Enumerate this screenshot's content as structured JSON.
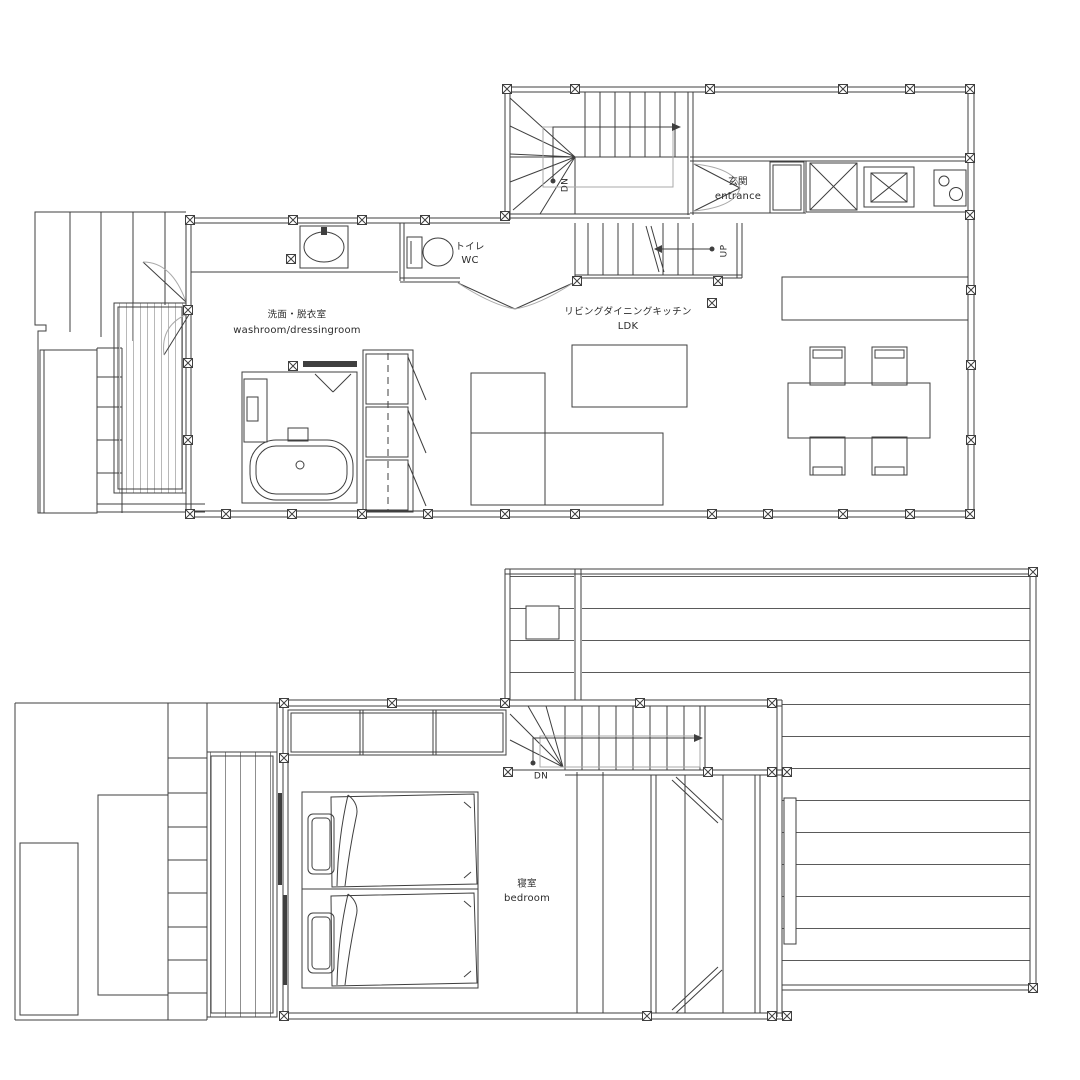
{
  "colors": {
    "line": "#3f3f3f",
    "light_line": "#a9a9a9",
    "background": "#ffffff",
    "engawa_stripe": "#b8b8b8",
    "deck_stripe": "#5a5a5a"
  },
  "floor1": {
    "rooms": {
      "toilet": {
        "jp": "トイレ",
        "en": "WC"
      },
      "washroom": {
        "jp": "洗面・脱衣室",
        "en": "washroom/dressingroom"
      },
      "ldk": {
        "jp": "リビングダイニングキッチン",
        "en": "LDK"
      },
      "entrance": {
        "jp": "玄関",
        "en": "entrance"
      }
    },
    "stair_annotations": {
      "down": "DN",
      "up": "UP"
    }
  },
  "floor2": {
    "rooms": {
      "bedroom": {
        "jp": "寝室",
        "en": "bedroom"
      }
    },
    "stair_annotations": {
      "down": "DN"
    }
  }
}
